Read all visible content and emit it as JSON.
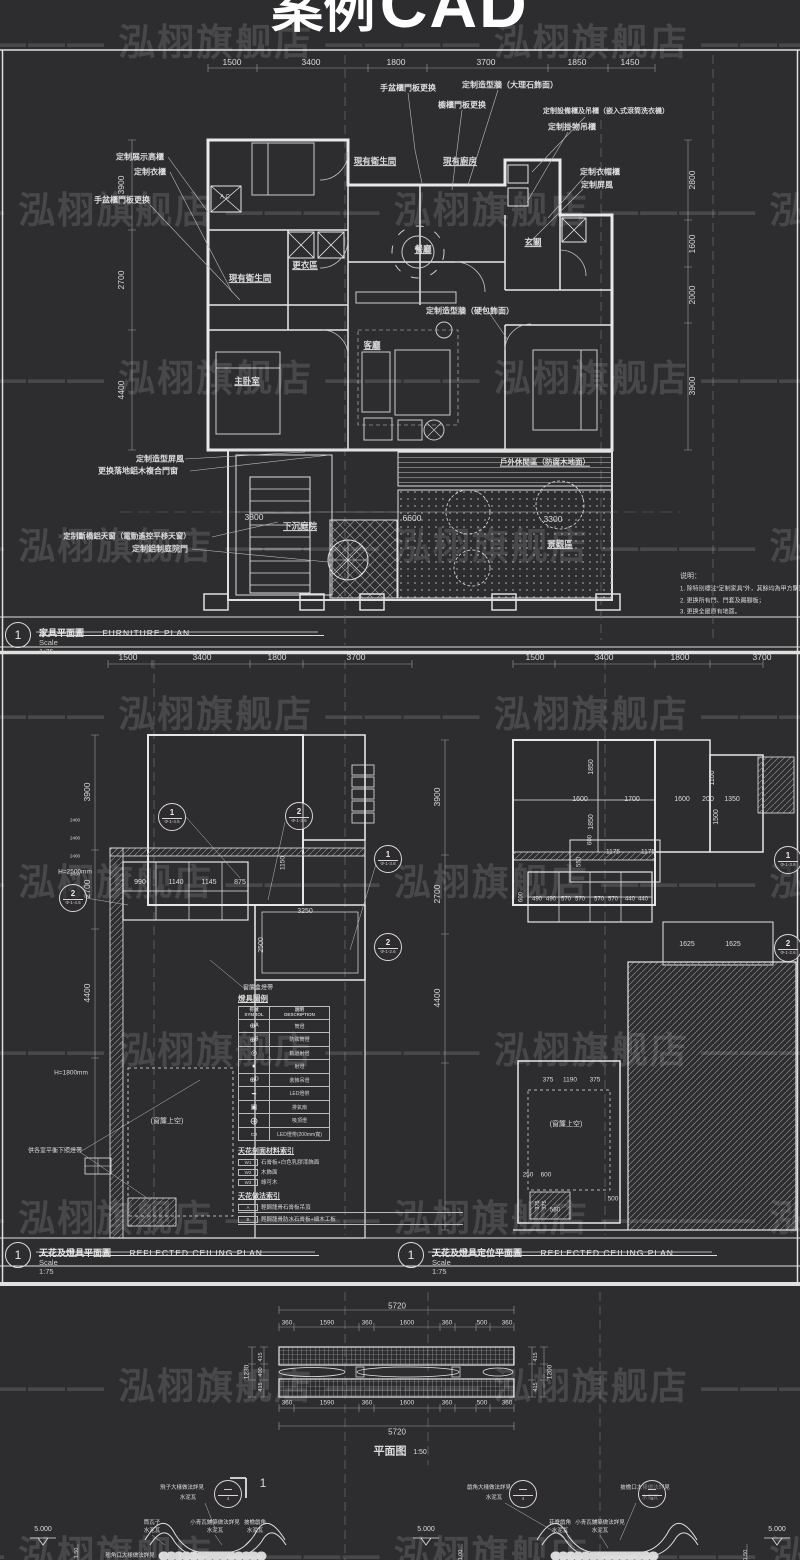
{
  "header": {
    "title_cn": "案例",
    "title_en": "CAD"
  },
  "watermark": {
    "text": "泓栩旗舰店",
    "dash": "————",
    "rows": [
      12,
      180,
      348,
      516,
      684,
      852,
      1020,
      1188,
      1356,
      1524
    ]
  },
  "title_blocks": {
    "p1": {
      "no": "1",
      "cn": "家具平面圖",
      "en": "FURNITURE PLAN",
      "scale": "Scale 1:75"
    },
    "p2l": {
      "no": "1",
      "cn": "天花及燈具平面圖",
      "en": "REFLECTED CEILING PLAN",
      "scale": "Scale 1:75"
    },
    "p2r": {
      "no": "1",
      "cn": "天花及燈具定位平面圖",
      "en": "REFLECTED CEILING PLAN",
      "scale": "Scale 1:75"
    }
  },
  "legend": {
    "title": "燈具圖例",
    "headers": {
      "col1_cn": "符號",
      "col1_en": "SYMBOL",
      "col2_cn": "說明",
      "col2_en": "DESCRIPTION"
    },
    "rows": [
      {
        "sym": "⊕ᴬ",
        "desc": "筒燈"
      },
      {
        "sym": "⊕ᴮ",
        "desc": "防眩筒燈"
      },
      {
        "sym": "◎",
        "desc": "軌道射燈"
      },
      {
        "sym": "●",
        "desc": "射燈"
      },
      {
        "sym": "⊕ᴰ",
        "desc": "裝飾吊燈"
      },
      {
        "sym": "━",
        "desc": "LED燈帶"
      },
      {
        "sym": "▣",
        "desc": "排氣扇"
      },
      {
        "sym": "⨁",
        "desc": "吸頂燈"
      },
      {
        "sym": "▭",
        "desc": "LED燈帶(200mm寬)"
      }
    ],
    "material_title": "天花剖面材料索引",
    "materials": [
      {
        "code": "W1",
        "desc": "石膏板+白色乳膠漆飾面"
      },
      {
        "code": "W2",
        "desc": "木飾面"
      },
      {
        "code": "W3",
        "desc": "綠可木"
      }
    ],
    "method_title": "天花做法索引",
    "methods": [
      {
        "code": "A",
        "desc": "輕鋼龍骨石膏板吊頂"
      },
      {
        "code": "B",
        "desc": "輕鋼龍骨防水石膏板+細木工板"
      }
    ]
  },
  "markers": [
    {
      "x": 172,
      "y": 817,
      "a": "1",
      "b": "Φ-1-4.5"
    },
    {
      "x": 299,
      "y": 816,
      "a": "2",
      "b": "Φ-1-3.6"
    },
    {
      "x": 73,
      "y": 898,
      "a": "2",
      "b": "Φ-1-4.5"
    },
    {
      "x": 388,
      "y": 859,
      "a": "1",
      "b": "Φ-1-3.8"
    },
    {
      "x": 388,
      "y": 947,
      "a": "2",
      "b": "Φ-1-2.6"
    },
    {
      "x": 788,
      "y": 860,
      "a": "1",
      "b": "Φ-1-3.8"
    },
    {
      "x": 788,
      "y": 948,
      "a": "2",
      "b": "Φ-1-2.6"
    },
    {
      "x": 228,
      "y": 1494,
      "a": "—",
      "b": "4"
    },
    {
      "x": 523,
      "y": 1494,
      "a": "—",
      "b": "4"
    },
    {
      "x": 652,
      "y": 1494,
      "a": "—",
      "b": "4"
    }
  ],
  "labels": {
    "p1_dims_top": [
      [
        232,
        63,
        "1500"
      ],
      [
        311,
        63,
        "3400"
      ],
      [
        396,
        63,
        "1800"
      ],
      [
        486,
        63,
        "3700"
      ],
      [
        577,
        63,
        "1850"
      ],
      [
        630,
        63,
        "1450"
      ]
    ],
    "p1_dims_left": [
      [
        122,
        185,
        "3900",
        {
          "r": -90
        }
      ],
      [
        122,
        280,
        "2700",
        {
          "r": -90
        }
      ],
      [
        122,
        390,
        "4400",
        {
          "r": -90
        }
      ]
    ],
    "p1_dims_right": [
      [
        693,
        180,
        "2800",
        {
          "r": -90
        }
      ],
      [
        693,
        244,
        "1600",
        {
          "r": -90
        }
      ],
      [
        693,
        295,
        "2000",
        {
          "r": -90
        }
      ],
      [
        693,
        386,
        "3900",
        {
          "r": -90
        }
      ]
    ],
    "p1_rooms": [
      [
        375,
        162,
        "現有衛生間",
        {
          "u": 1,
          "b": 1
        }
      ],
      [
        460,
        162,
        "現有廚房",
        {
          "u": 1,
          "b": 1
        }
      ],
      [
        423,
        250,
        "餐廳",
        {
          "u": 1,
          "b": 1
        }
      ],
      [
        533,
        243,
        "玄關",
        {
          "u": 1,
          "b": 1
        }
      ],
      [
        305,
        266,
        "更衣區",
        {
          "u": 1,
          "b": 1
        }
      ],
      [
        250,
        279,
        "現有衛生間",
        {
          "u": 1,
          "b": 1
        }
      ],
      [
        372,
        346,
        "客廳",
        {
          "u": 1,
          "b": 1
        }
      ],
      [
        247,
        382,
        "主卧室",
        {
          "u": 1,
          "b": 1
        }
      ],
      [
        300,
        527,
        "下沉庭院",
        {
          "u": 1,
          "b": 1
        }
      ],
      [
        545,
        463,
        "戶外休閒區（防腐木地面）",
        {
          "u": 1,
          "b": 1,
          "fs": 7.5
        }
      ],
      [
        560,
        545,
        "景觀區",
        {
          "u": 1,
          "b": 1
        }
      ]
    ],
    "p1_court_dims": [
      [
        254,
        518,
        "3800"
      ],
      [
        412,
        519,
        "6600"
      ],
      [
        553,
        520,
        "3300"
      ]
    ],
    "p1_callouts": [
      [
        408,
        88,
        "手盆櫃門板更换",
        {
          "b": 1,
          "fs": 8
        }
      ],
      [
        510,
        85,
        "定制造型牆（大理石飾面）",
        {
          "b": 1,
          "fs": 8
        }
      ],
      [
        462,
        105,
        "櫥櫃門板更换",
        {
          "b": 1,
          "fs": 8
        }
      ],
      [
        606,
        112,
        "定制設備櫃及吊櫃（嵌入式滾筒洗衣機）",
        {
          "b": 1,
          "fs": 7
        }
      ],
      [
        572,
        127,
        "定制掛物吊櫃",
        {
          "b": 1,
          "fs": 8
        }
      ],
      [
        600,
        172,
        "定制衣帽櫃",
        {
          "b": 1,
          "fs": 8
        }
      ],
      [
        597,
        185,
        "定制屏風",
        {
          "b": 1,
          "fs": 8
        }
      ],
      [
        140,
        157,
        "定制展示高櫃",
        {
          "b": 1,
          "fs": 8
        }
      ],
      [
        150,
        172,
        "定制衣櫃",
        {
          "b": 1,
          "fs": 8
        }
      ],
      [
        122,
        200,
        "手盆櫃門板更换",
        {
          "b": 1,
          "fs": 8
        }
      ],
      [
        470,
        311,
        "定制造型牆（硬包飾面）",
        {
          "b": 1,
          "fs": 8
        }
      ],
      [
        160,
        459,
        "定制造型屏風",
        {
          "b": 1,
          "fs": 8
        }
      ],
      [
        138,
        471,
        "更换落地鋁木複合門窗",
        {
          "b": 1,
          "fs": 8
        }
      ],
      [
        127,
        537,
        "定制斷橋鋁天窗（電動遙控平移天窗）",
        {
          "b": 1,
          "fs": 7.5
        }
      ],
      [
        160,
        549,
        "定制鋁制庭院門",
        {
          "b": 1,
          "fs": 8
        }
      ],
      [
        225,
        198,
        "A C",
        {
          "fs": 6
        }
      ]
    ],
    "p1_notes": [
      [
        680,
        577,
        "说明：",
        {
          "al": "l",
          "fs": 7
        }
      ],
      [
        680,
        590,
        "1. 除特別標注“定制家具”外，其餘均為甲方購置家具；",
        {
          "al": "l",
          "fs": 6
        }
      ],
      [
        680,
        602,
        "2. 更换所有門、門套及踢腳板；",
        {
          "al": "l",
          "fs": 6
        }
      ],
      [
        680,
        613,
        "3. 更换全屋原有地面。",
        {
          "al": "l",
          "fs": 6
        }
      ]
    ],
    "p2_dims": [
      [
        128,
        658,
        "1500"
      ],
      [
        202,
        658,
        "3400"
      ],
      [
        277,
        658,
        "1800"
      ],
      [
        356,
        658,
        "3700"
      ],
      [
        535,
        658,
        "1500"
      ],
      [
        604,
        658,
        "3400"
      ],
      [
        680,
        658,
        "1800"
      ],
      [
        762,
        658,
        "3700"
      ],
      [
        88,
        792,
        "3900",
        {
          "r": -90
        }
      ],
      [
        88,
        889,
        "2700",
        {
          "r": -90
        }
      ],
      [
        88,
        993,
        "4400",
        {
          "r": -90
        }
      ],
      [
        438,
        797,
        "3900",
        {
          "r": -90
        }
      ],
      [
        438,
        894,
        "2700",
        {
          "r": -90
        }
      ],
      [
        438,
        998,
        "4400",
        {
          "r": -90
        }
      ]
    ],
    "p2_inner_dims": [
      [
        140,
        883,
        "990",
        {
          "fs": 7
        }
      ],
      [
        176,
        883,
        "1140",
        {
          "fs": 7
        }
      ],
      [
        209,
        883,
        "1145",
        {
          "fs": 7
        }
      ],
      [
        240,
        883,
        "875",
        {
          "fs": 7
        }
      ],
      [
        305,
        912,
        "3250",
        {
          "fs": 7
        }
      ],
      [
        262,
        945,
        "2500",
        {
          "r": -90,
          "fs": 7
        }
      ],
      [
        283,
        863,
        "1150",
        {
          "r": -90,
          "fs": 6.5
        }
      ],
      [
        592,
        767,
        "1850",
        {
          "r": -90,
          "fs": 7
        }
      ],
      [
        580,
        800,
        "1600",
        {
          "fs": 7
        }
      ],
      [
        632,
        800,
        "1700",
        {
          "fs": 7
        }
      ],
      [
        592,
        822,
        "1850",
        {
          "r": -90,
          "fs": 7
        }
      ],
      [
        682,
        800,
        "1600",
        {
          "fs": 7
        }
      ],
      [
        708,
        800,
        "200",
        {
          "fs": 7
        }
      ],
      [
        732,
        800,
        "1350",
        {
          "fs": 7
        }
      ],
      [
        713,
        778,
        "1100",
        {
          "r": -90,
          "fs": 7
        }
      ],
      [
        717,
        817,
        "1500",
        {
          "r": -90,
          "fs": 7
        }
      ],
      [
        613,
        852,
        "1175",
        {
          "fs": 6.5
        }
      ],
      [
        648,
        852,
        "1175",
        {
          "fs": 6.5
        }
      ],
      [
        591,
        840,
        "600",
        {
          "r": -90,
          "fs": 6
        }
      ],
      [
        580,
        862,
        "550",
        {
          "r": -90,
          "fs": 6
        }
      ],
      [
        522,
        897,
        "600",
        {
          "r": -90,
          "fs": 6
        }
      ],
      [
        537,
        900,
        "490",
        {
          "fs": 6
        }
      ],
      [
        551,
        900,
        "490",
        {
          "fs": 6
        }
      ],
      [
        566,
        900,
        "570",
        {
          "fs": 6
        }
      ],
      [
        580,
        900,
        "570",
        {
          "fs": 6
        }
      ],
      [
        599,
        900,
        "570",
        {
          "fs": 6
        }
      ],
      [
        613,
        900,
        "570",
        {
          "fs": 6
        }
      ],
      [
        630,
        900,
        "440",
        {
          "fs": 6
        }
      ],
      [
        643,
        900,
        "440",
        {
          "fs": 6
        }
      ],
      [
        687,
        945,
        "1625",
        {
          "fs": 7
        }
      ],
      [
        733,
        945,
        "1625",
        {
          "fs": 7
        }
      ],
      [
        548,
        1080,
        "375",
        {
          "fs": 6.5
        }
      ],
      [
        570,
        1080,
        "1190",
        {
          "fs": 6.5
        }
      ],
      [
        595,
        1080,
        "375",
        {
          "fs": 6.5
        }
      ],
      [
        528,
        1175,
        "250",
        {
          "fs": 6.5
        }
      ],
      [
        546,
        1175,
        "600",
        {
          "fs": 6.5
        }
      ],
      [
        613,
        1199,
        "500",
        {
          "fs": 6.5
        }
      ],
      [
        555,
        1210,
        "560",
        {
          "fs": 6.5
        }
      ],
      [
        538,
        1205,
        "375",
        {
          "r": -90,
          "fs": 5.5
        }
      ],
      [
        545,
        1205,
        "375",
        {
          "r": -90,
          "fs": 5.5
        }
      ]
    ],
    "p2_texts": [
      [
        75,
        872,
        "H=2500mm",
        {
          "fs": 6.5
        }
      ],
      [
        71,
        1073,
        "H=1800mm",
        {
          "fs": 6.5
        }
      ],
      [
        167,
        1122,
        "(窗簾上空)",
        {
          "fs": 7
        }
      ],
      [
        566,
        1125,
        "(窗簾上空)",
        {
          "fs": 7
        }
      ],
      [
        55,
        1152,
        "供各室平衡下照燈帶",
        {
          "fs": 6
        }
      ],
      [
        258,
        989,
        "窗簾盒燈帶",
        {
          "fs": 6
        }
      ],
      [
        75,
        820,
        "2400",
        {
          "fs": 4.5
        }
      ],
      [
        75,
        838,
        "2400",
        {
          "fs": 4.5
        }
      ],
      [
        75,
        856,
        "2400",
        {
          "fs": 4.5
        }
      ],
      [
        75,
        874,
        "2400",
        {
          "fs": 4.5
        }
      ]
    ],
    "p3_dims": [
      [
        397,
        1306,
        "5720",
        {
          "fs": 8
        }
      ],
      [
        287,
        1323,
        "360",
        {
          "fs": 6.5
        }
      ],
      [
        327,
        1323,
        "1590",
        {
          "fs": 6.5
        }
      ],
      [
        367,
        1323,
        "360",
        {
          "fs": 6.5
        }
      ],
      [
        407,
        1323,
        "1600",
        {
          "fs": 6.5
        }
      ],
      [
        447,
        1323,
        "360",
        {
          "fs": 6.5
        }
      ],
      [
        482,
        1323,
        "500",
        {
          "fs": 6.5
        }
      ],
      [
        507,
        1323,
        "360",
        {
          "fs": 6.5
        }
      ],
      [
        287,
        1403,
        "360",
        {
          "fs": 6.5
        }
      ],
      [
        327,
        1403,
        "1590",
        {
          "fs": 6.5
        }
      ],
      [
        367,
        1403,
        "360",
        {
          "fs": 6.5
        }
      ],
      [
        407,
        1403,
        "1600",
        {
          "fs": 6.5
        }
      ],
      [
        447,
        1403,
        "360",
        {
          "fs": 6.5
        }
      ],
      [
        482,
        1403,
        "500",
        {
          "fs": 6.5
        }
      ],
      [
        507,
        1403,
        "360",
        {
          "fs": 6.5
        }
      ],
      [
        397,
        1432,
        "5720",
        {
          "fs": 8
        }
      ],
      [
        247,
        1372,
        "1230",
        {
          "r": -90,
          "fs": 6.5
        }
      ],
      [
        261,
        1357,
        "415",
        {
          "r": -90,
          "fs": 5.5
        }
      ],
      [
        261,
        1372,
        "400",
        {
          "r": -90,
          "fs": 5.5
        }
      ],
      [
        261,
        1387,
        "415",
        {
          "r": -90,
          "fs": 5.5
        }
      ],
      [
        536,
        1357,
        "415",
        {
          "r": -90,
          "fs": 5.5
        }
      ],
      [
        536,
        1387,
        "415",
        {
          "r": -90,
          "fs": 5.5
        }
      ],
      [
        550,
        1372,
        "1200",
        {
          "r": -90,
          "fs": 6.5
        }
      ]
    ],
    "p3_texts": [
      [
        390,
        1452,
        "平面图",
        {
          "b": 1,
          "fs": 11
        }
      ],
      [
        420,
        1453,
        "1:50",
        {
          "fs": 7
        }
      ],
      [
        263,
        1484,
        "1",
        {
          "fs": 12
        }
      ],
      [
        43,
        1530,
        "5.000",
        {
          "fs": 7
        }
      ],
      [
        426,
        1530,
        "5.000",
        {
          "fs": 7
        }
      ],
      [
        777,
        1530,
        "5.000",
        {
          "fs": 7
        }
      ],
      [
        77,
        1553,
        "1.50",
        {
          "r": -90,
          "fs": 5.5
        }
      ],
      [
        461,
        1555,
        "1.00",
        {
          "r": -90,
          "fs": 5.5
        }
      ],
      [
        746,
        1555,
        "1.50",
        {
          "r": -90,
          "fs": 5.5
        }
      ]
    ],
    "p3_details": [
      [
        182,
        1488,
        "飛子大樣做法詳見",
        {
          "fs": 5.5
        }
      ],
      [
        188,
        1498,
        "水泥瓦",
        {
          "fs": 5.5
        }
      ],
      [
        152,
        1523,
        "筒瓦子",
        {
          "fs": 5.5
        }
      ],
      [
        152,
        1531,
        "水泥瓦",
        {
          "fs": 5.5
        }
      ],
      [
        215,
        1523,
        "小青瓦鋪築做法詳見",
        {
          "fs": 5.5
        }
      ],
      [
        215,
        1531,
        "水泥瓦",
        {
          "fs": 5.5
        }
      ],
      [
        255,
        1523,
        "披檐戧角",
        {
          "fs": 5.5
        }
      ],
      [
        255,
        1531,
        "水泥瓦",
        {
          "fs": 5.5
        }
      ],
      [
        489,
        1488,
        "戧角大樣做法詳見",
        {
          "fs": 5.5
        }
      ],
      [
        494,
        1498,
        "水泥瓦",
        {
          "fs": 5.5
        }
      ],
      [
        645,
        1488,
        "披檐口大樣做法詳見",
        {
          "fs": 5.5
        }
      ],
      [
        650,
        1498,
        "水泥瓦",
        {
          "fs": 5.5
        }
      ],
      [
        560,
        1523,
        "花脊戧角",
        {
          "fs": 5.5
        }
      ],
      [
        560,
        1531,
        "水泥瓦",
        {
          "fs": 5.5
        }
      ],
      [
        600,
        1523,
        "小青瓦鋪築做法詳見",
        {
          "fs": 5.5
        }
      ],
      [
        600,
        1531,
        "水泥瓦",
        {
          "fs": 5.5
        }
      ],
      [
        130,
        1556,
        "翹角口大樣做法詳見",
        {
          "fs": 5.5
        }
      ]
    ]
  }
}
